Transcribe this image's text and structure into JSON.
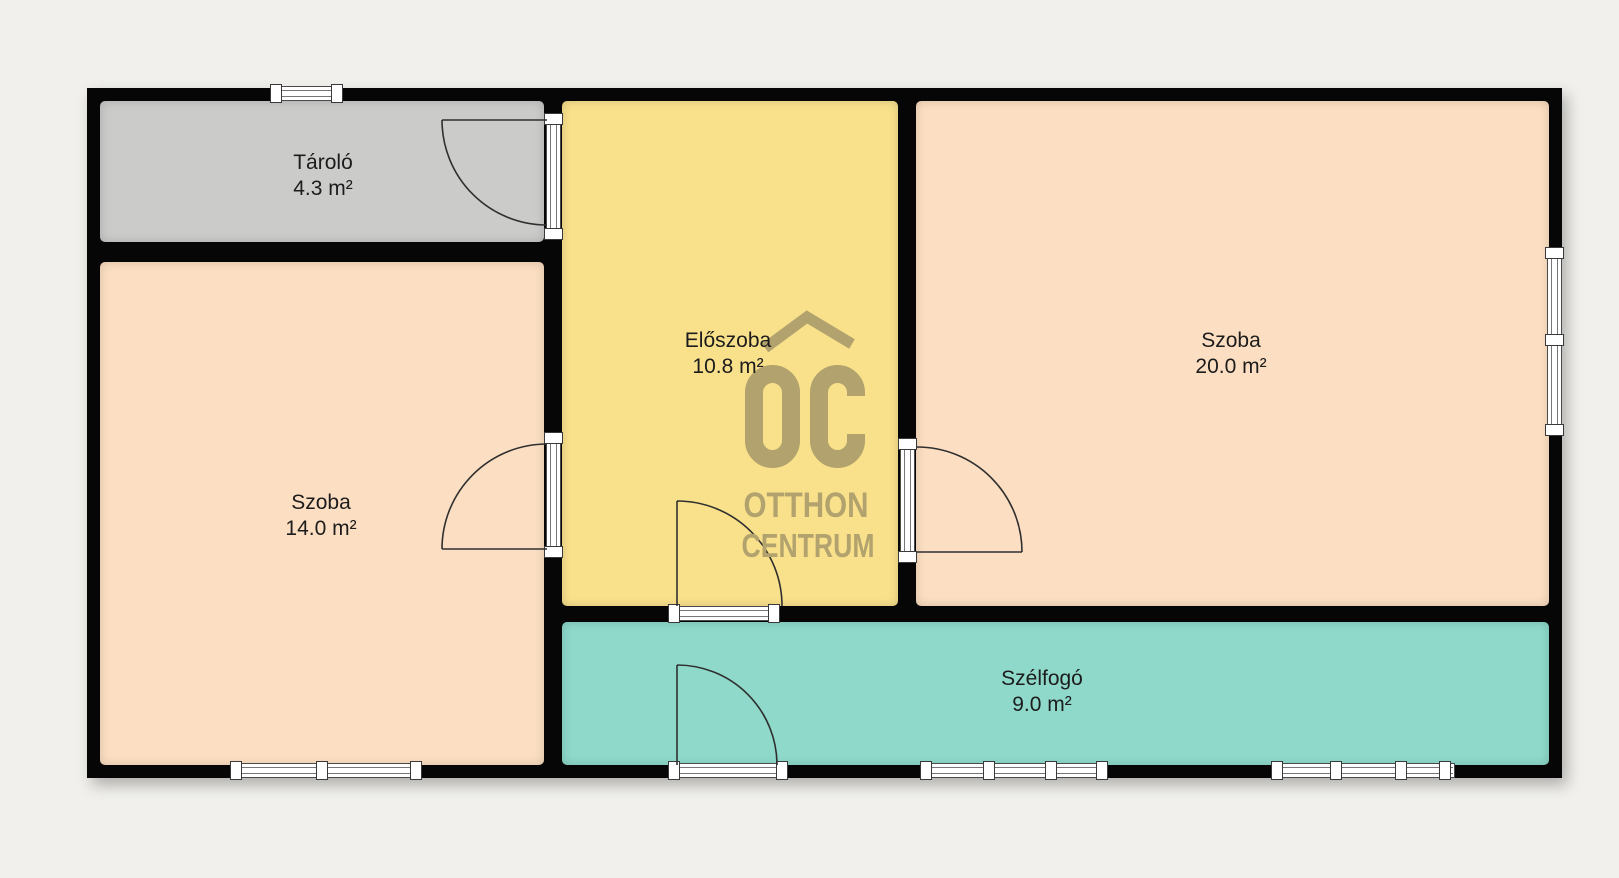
{
  "page": {
    "background_color": "#f1f0ec"
  },
  "plan": {
    "wall_color": "#060606",
    "rooms": [
      {
        "name": "Tároló",
        "area": "4.3 m²",
        "color": "#cbcbca"
      },
      {
        "name": "Szoba",
        "area": "14.0 m²",
        "color": "#fcdfc2"
      },
      {
        "name": "Előszoba",
        "area": "10.8 m²",
        "color": "#f9e18c"
      },
      {
        "name": "Szoba",
        "area": "20.0 m²",
        "color": "#fcdfc2"
      },
      {
        "name": "Szélfogó",
        "area": "9.0 m²",
        "color": "#8ed9ca"
      }
    ],
    "watermark": {
      "brand_initials": "OC",
      "line1": "OTTHON",
      "line2": "CENTRUM",
      "color": "#b2a26d"
    }
  }
}
